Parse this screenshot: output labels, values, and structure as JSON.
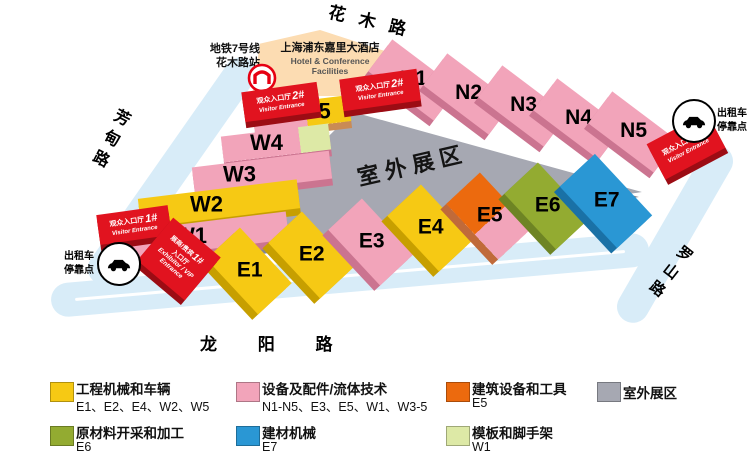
{
  "map": {
    "roads": {
      "north": "花木路",
      "west": "芳甸路",
      "south": "龙 阳 路",
      "east": "罗山路"
    },
    "metro": {
      "line1": "地铁7号线",
      "line2": "花木路站"
    },
    "hotel": {
      "cn": "上海浦东嘉里大酒店",
      "en1": "Hotel & Conference",
      "en2": "Facilities"
    },
    "outdoor_area_label": "室外展区",
    "taxi": {
      "line1": "出租车",
      "line2": "停靠点"
    },
    "halls": {
      "w": [
        "W1",
        "W2",
        "W3",
        "W4",
        "W5"
      ],
      "n": [
        "N1",
        "N2",
        "N3",
        "N4",
        "N5"
      ],
      "e": [
        "E1",
        "E2",
        "E3",
        "E4",
        "E5",
        "E6",
        "E7"
      ]
    },
    "entrances": {
      "visitor_label": "观众入口厅",
      "visitor_en": "Visitor Entrance",
      "vip_line1": "展商/贵宾",
      "vip_line2": "入口厅",
      "vip_en1": "Exhibitor / VIP",
      "vip_en2": "Entrance",
      "numbers": {
        "one": "1#",
        "two": "2#",
        "three": "3#"
      }
    }
  },
  "legend": {
    "items": [
      {
        "title": "工程机械和车辆",
        "halls": "E1、E2、E4、W2、W5"
      },
      {
        "title": "设备及配件/流体技术",
        "halls": "N1-N5、E3、E5、W1、W3-5"
      },
      {
        "title": "建筑设备和工具",
        "halls": "E5"
      },
      {
        "title": "室外展区",
        "halls": ""
      },
      {
        "title": "原材料开采和加工",
        "halls": "E6"
      },
      {
        "title": "建材机械",
        "halls": "E7"
      },
      {
        "title": "模板和脚手架",
        "halls": "W1"
      }
    ]
  },
  "colors": {
    "yellow": "#f6c914",
    "pink": "#f2a4ba",
    "orange": "#ec6a0e",
    "gray": "#a6a8b2",
    "olive": "#93ab31",
    "blue": "#2a97d4",
    "light_green": "#dde9a6",
    "entrance_red": "#e1131f",
    "road_blue": "#d8ecf8",
    "hotel_peach": "#fcdcb2",
    "metro_red": "#e60012"
  }
}
